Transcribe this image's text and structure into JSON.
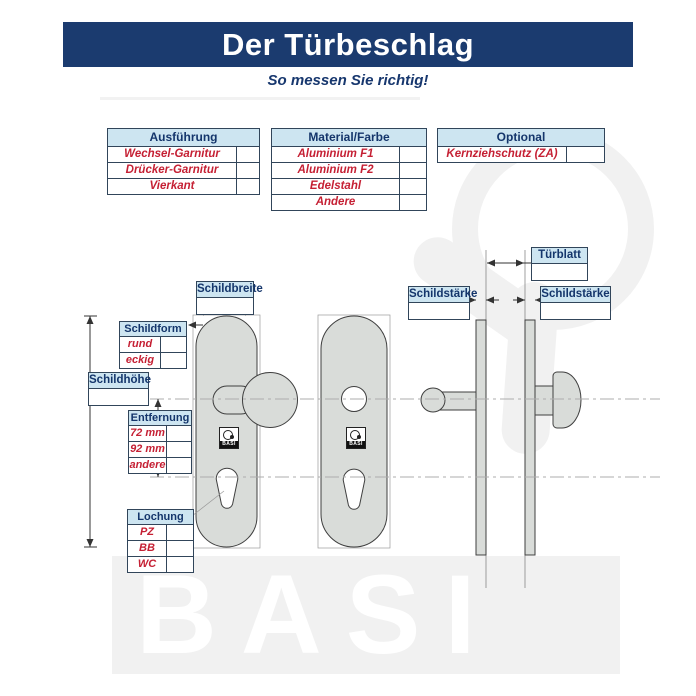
{
  "header": {
    "title": "Der Türbeschlag",
    "subtitle": "So messen Sie richtig!"
  },
  "tables": {
    "ausfuehrung": {
      "header": "Ausführung",
      "rows": [
        "Wechsel-Garnitur",
        "Drücker-Garnitur",
        "Vierkant"
      ]
    },
    "material": {
      "header": "Material/Farbe",
      "rows": [
        "Aluminium F1",
        "Aluminium F2",
        "Edelstahl",
        "Andere"
      ]
    },
    "optional": {
      "header": "Optional",
      "rows": [
        "Kernziehschutz (ZA)"
      ]
    }
  },
  "measurements": {
    "schildbreite": "Schildbreite",
    "schildform": {
      "header": "Schildform",
      "rows": [
        "rund",
        "eckig"
      ]
    },
    "schildhoehe": "Schildhöhe",
    "entfernung": {
      "header": "Entfernung",
      "rows": [
        "72 mm",
        "92 mm",
        "andere"
      ]
    },
    "lochung": {
      "header": "Lochung",
      "rows": [
        "PZ",
        "BB",
        "WC"
      ]
    },
    "tuerblatt": "Türblatt",
    "schildstaerke": "Schildstärke"
  },
  "brand": {
    "logo_text": "BASI",
    "watermark_text": "BASI"
  },
  "colors": {
    "banner_bg": "#1b3b6f",
    "table_header_bg": "#cde5f1",
    "heading_text": "#14356b",
    "value_text": "#c52034",
    "plate_fill": "#d9dcd9",
    "watermark": "#f1f1f1"
  }
}
